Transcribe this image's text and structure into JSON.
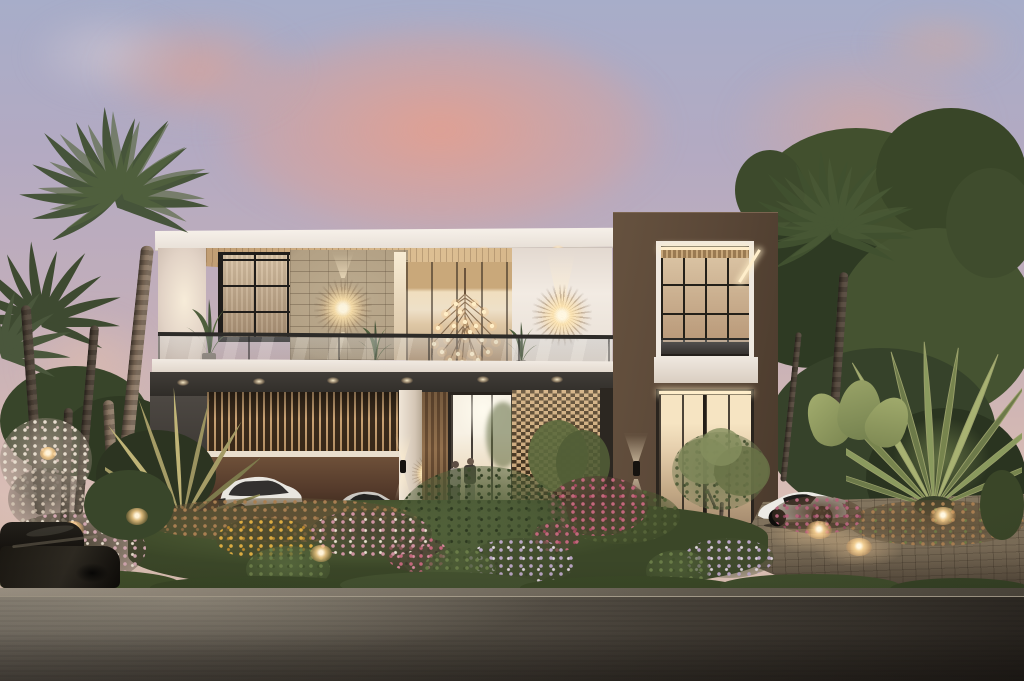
{
  "scene": {
    "type": "architectural-exterior-rendering",
    "description": "Photorealistic dusk rendering of a modern two-storey luxury villa with a white-framed upper balcony, wood slat ceiling, stone feature wall with starburst sconces, branching bulb chandelier, louvered carport with a white SUV and silver sedan, glass entry with two people, perforated brick lattice screen, dark-brown tower volume with LED-edged windows, palm trees, dense garden with pink, yellow, lavender and white flowers, a white sports car on a lit paver driveway, and a grey retaining wall with a dark car in the left foreground under a pink sunset sky",
    "time_of_day": "dusk",
    "objects": [
      "sunset-sky",
      "pink-clouds",
      "palm-trees",
      "tree-canopy",
      "villa-upper-balcony",
      "wood-slat-ceiling",
      "stone-feature-wall",
      "starburst-wall-sconces",
      "bulb-chandelier",
      "glass-balustrade",
      "balcony-plants",
      "carport-louver-screen",
      "white-suv",
      "silver-sedan",
      "entry-glass-doors",
      "two-people",
      "perforated-lattice-screen",
      "brown-tower",
      "led-strip-windows",
      "up-down-wall-sconces",
      "travelers-palm",
      "garden-flower-beds",
      "garden-path-lights",
      "paver-driveway",
      "ground-lights",
      "white-sports-car",
      "retaining-wall",
      "dark-foreground-car"
    ]
  },
  "palette": {
    "sky_top": "#a7adc9",
    "sky_mid": "#c2aeba",
    "sky_low": "#dec2b6",
    "cloud_pink": "#e89e8a",
    "cloud_pale": "#cfc6d2",
    "facade_white": "#f2ebe3",
    "wood_ceiling": "#ddbf93",
    "stone": "#b2a084",
    "tower_brown": "#5b4838",
    "slat_wood": "#c9a273",
    "screen_tan": "#c9a77b",
    "garage_brown": "#53392a",
    "glass_warm": "#eee0c8",
    "glow_warm": "#ffeecb",
    "frame_black": "#201d1a",
    "rail_dark": "#2d2b28",
    "foliage_dark": "#36422a",
    "foliage_mid": "#46543a",
    "foliage_lit": "#5f6d41",
    "palm_lit": "#a59c66",
    "fern_green": "#55663c",
    "grass": "#4a5830",
    "lawn_lit": "#5a683c",
    "flower_pink": "#c3677c",
    "flower_magenta": "#a84a61",
    "flower_yellow": "#dcab41",
    "flower_lavender": "#b9a5c4",
    "flower_white": "#e8dfcf",
    "flower_rust": "#a87e51",
    "drive_tan": "#7c6e59",
    "wall_lit": "#8e877a",
    "wall_dark": "#302c26",
    "car_white": "#eceae5",
    "car_silver": "#cbc8c2"
  }
}
